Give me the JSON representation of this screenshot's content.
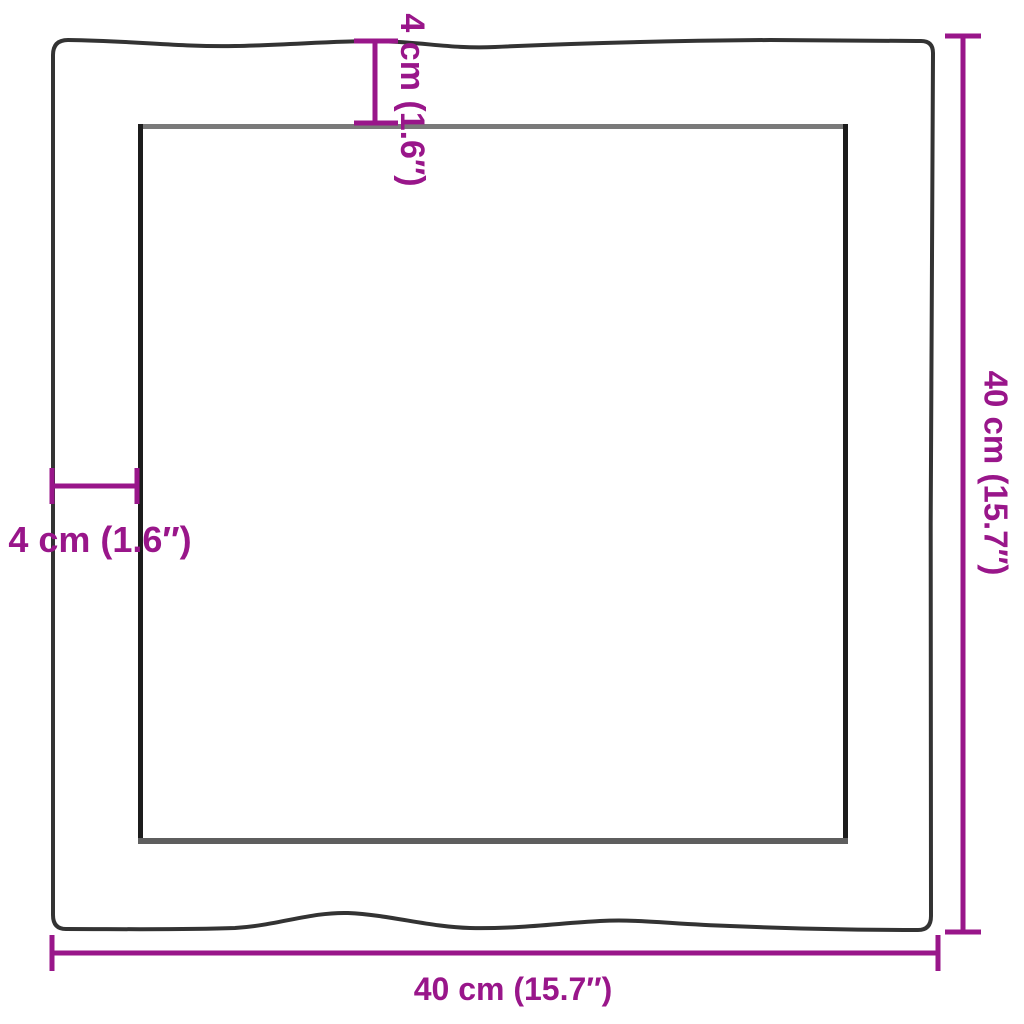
{
  "diagram": {
    "type": "product-dimension-diagram",
    "subject": "square-live-edge-tabletop-top-view",
    "labels": {
      "top": "4 cm (1.6″)",
      "left": "4 cm (1.6″)",
      "right": "40 cm (15.7″)",
      "bottom": "40 cm (15.7″)"
    },
    "dimensions": {
      "edge_width_cm": 4,
      "edge_width_in": 1.6,
      "overall_width_cm": 40,
      "overall_width_in": 15.7,
      "overall_height_cm": 40,
      "overall_height_in": 15.7
    },
    "colors": {
      "dimension": "#99168A",
      "edge_dark": "#333333",
      "inner_side": "#1c1c1c",
      "inner_top": "#7a7a7a",
      "inner_bottom": "#5e5e5e",
      "background": "#ffffff"
    }
  }
}
